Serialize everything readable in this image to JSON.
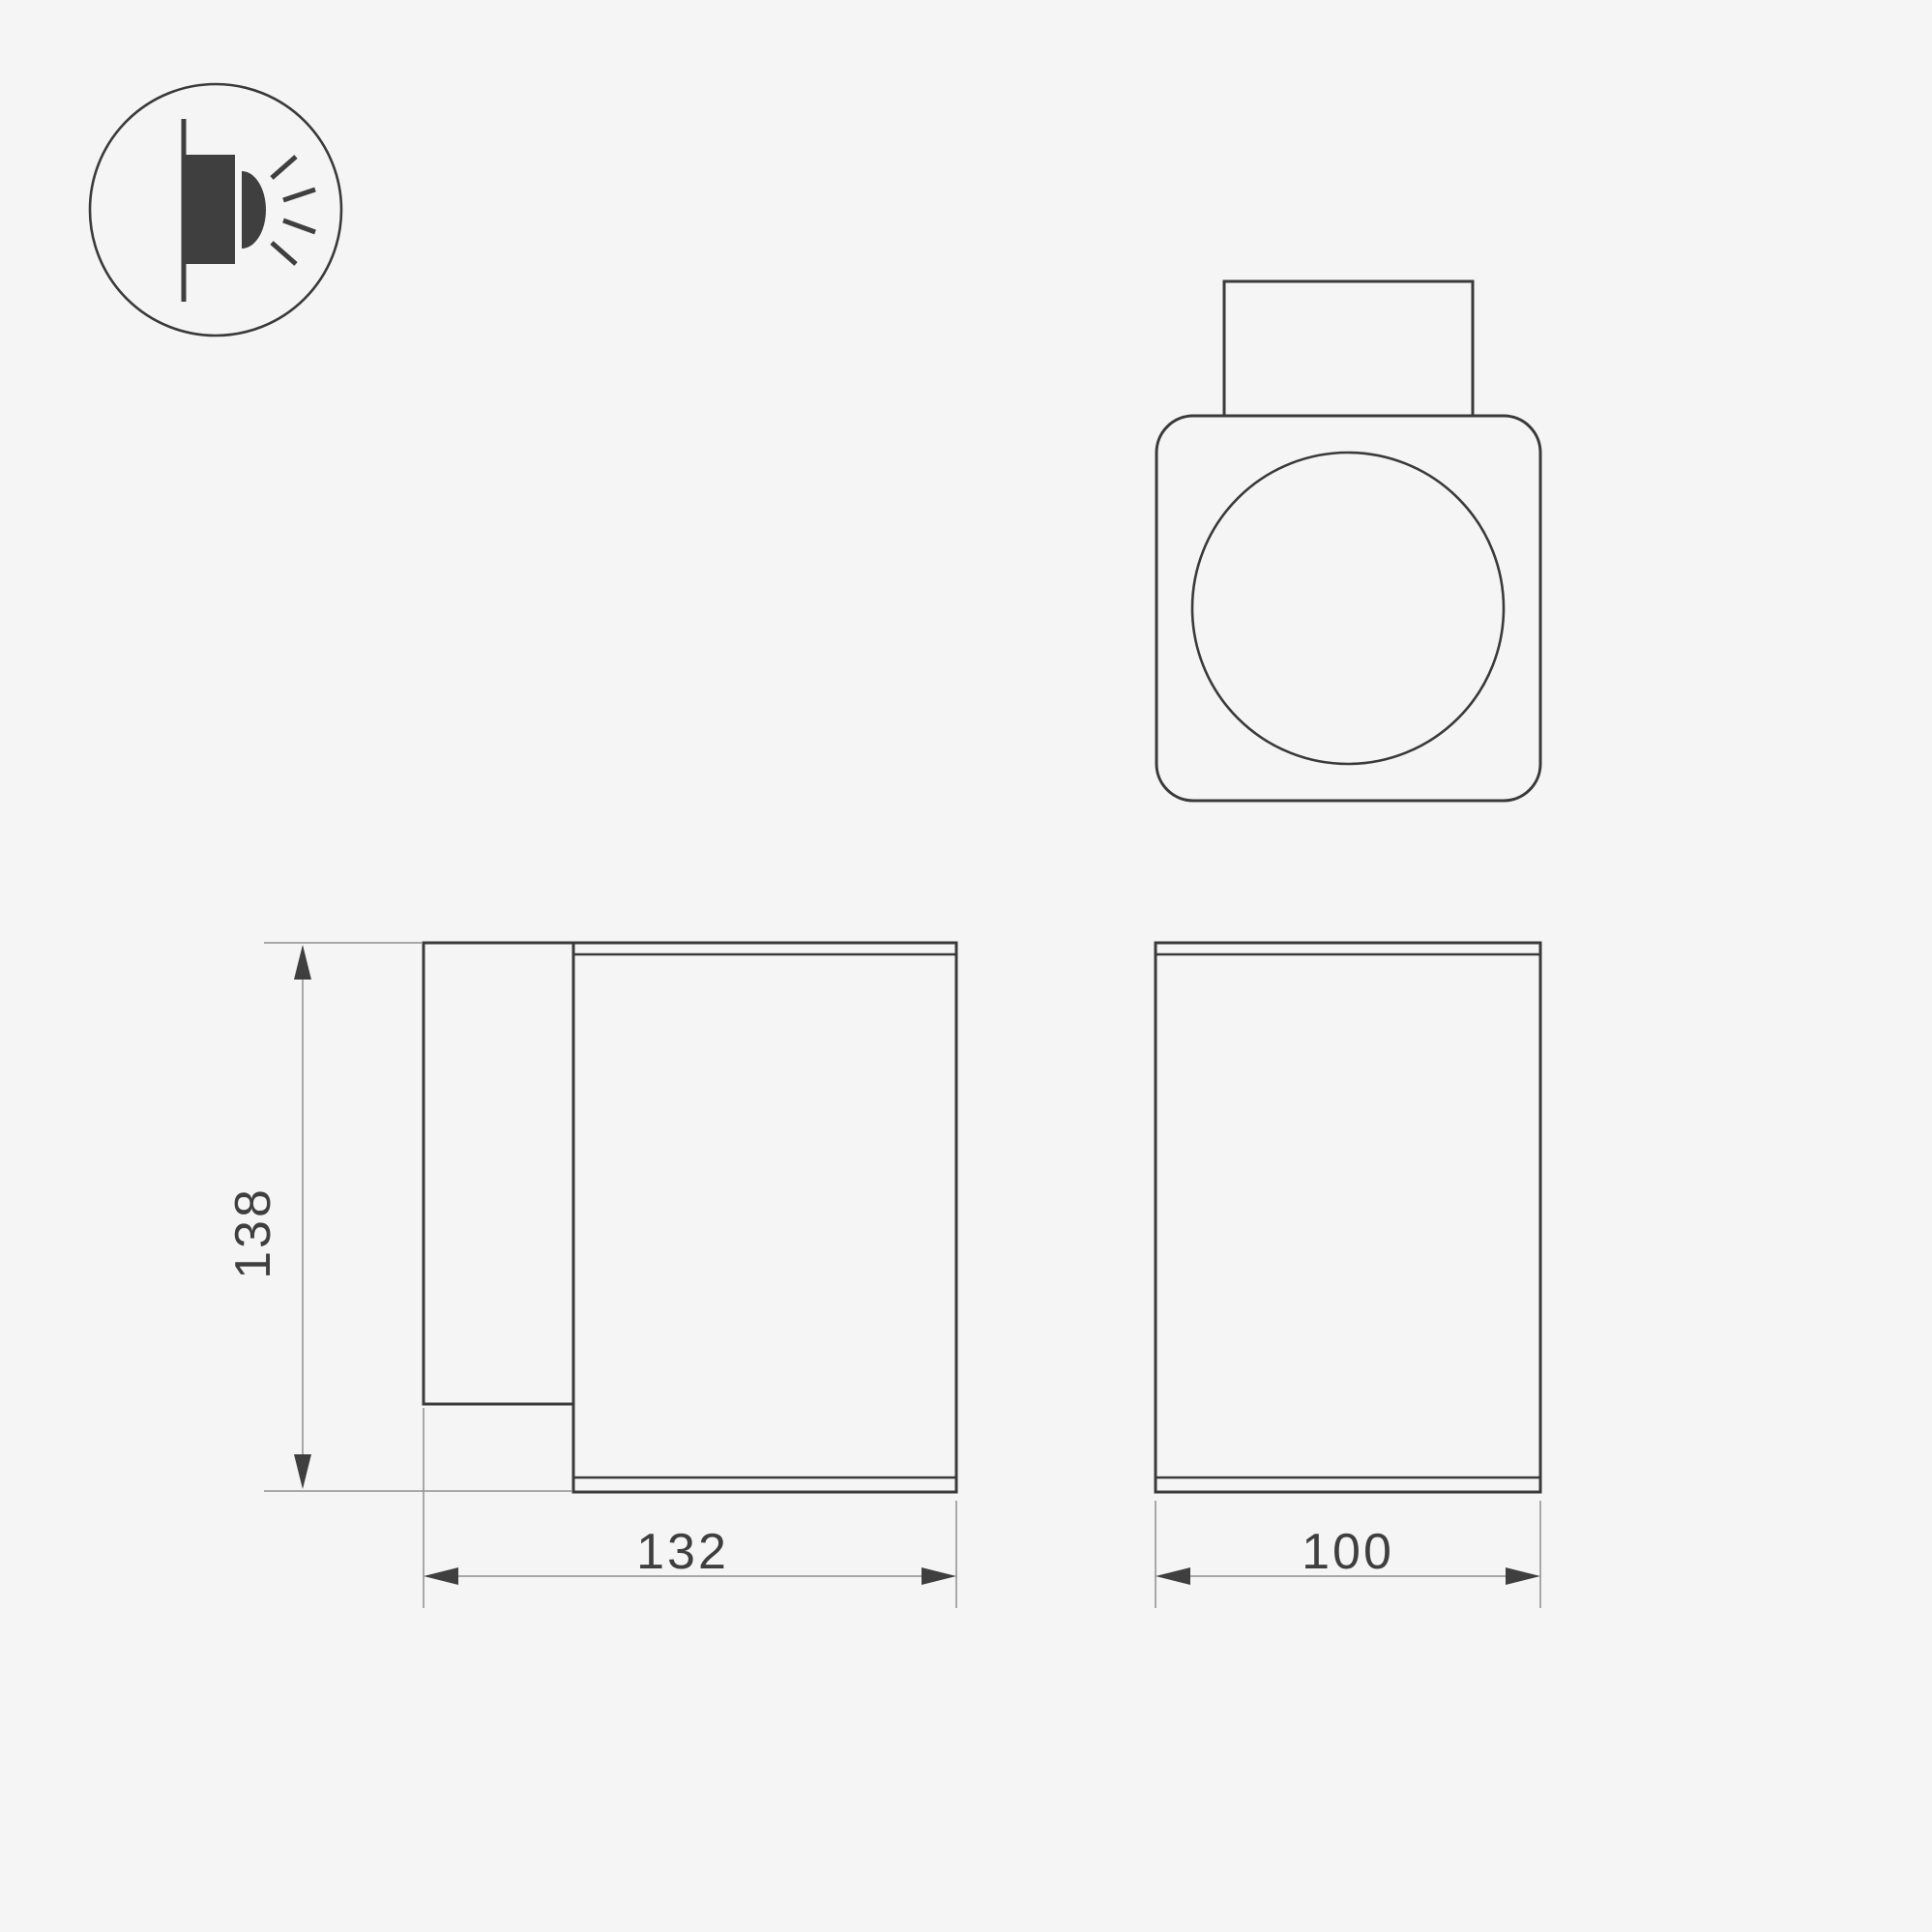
{
  "document": {
    "type": "technical-drawing",
    "subject": "wall-mounted luminaire dimensional drawing",
    "background_color": "#f5f5f5",
    "line_color": "#3a3a3a",
    "dimension_line_color": "#8f8f8f",
    "dimension_text_color": "#3f3f3f",
    "icon_fill_color": "#3f3f3f"
  },
  "icon": {
    "semantic": "wall-light-side-emission-icon",
    "description": "circle badge with wall line, lamp body and light rays"
  },
  "views": {
    "top_view": {
      "label": "top view with round diffuser and mounting box"
    },
    "side_view": {
      "label": "side view with wall bracket and body"
    },
    "front_view": {
      "label": "front view of body"
    }
  },
  "dimensions": {
    "height": {
      "value": "138"
    },
    "depth": {
      "value": "132"
    },
    "width": {
      "value": "100"
    }
  }
}
